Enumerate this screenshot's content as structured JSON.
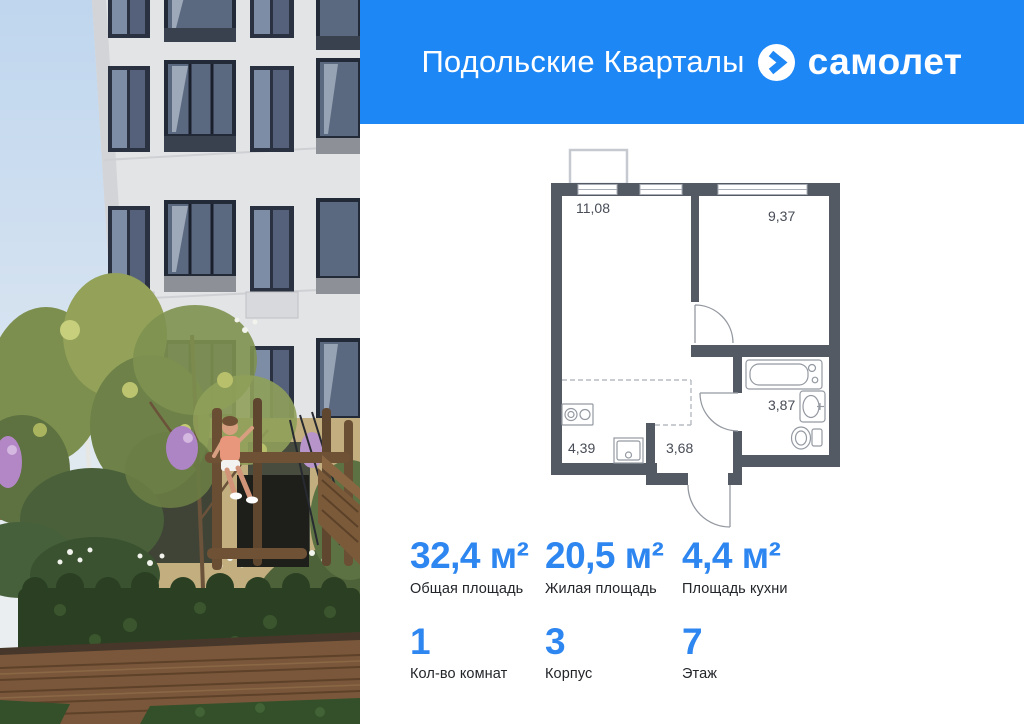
{
  "header": {
    "project_title": "Подольские Кварталы",
    "brand": "самолет",
    "header_bg": "#1e87f6",
    "accent_blue": "#2e86f0"
  },
  "plan": {
    "wall_color": "#545a64",
    "rooms": [
      {
        "name": "living-room",
        "area": "11,08"
      },
      {
        "name": "bedroom",
        "area": "9,37"
      },
      {
        "name": "kitchen",
        "area": "4,39"
      },
      {
        "name": "hall",
        "area": "3,68"
      },
      {
        "name": "bathroom",
        "area": "3,87"
      }
    ]
  },
  "stats": {
    "items": [
      {
        "value": "32,4 м²",
        "label": "Общая площадь"
      },
      {
        "value": "20,5 м²",
        "label": "Жилая площадь"
      },
      {
        "value": "4,4 м²",
        "label": "Площадь кухни"
      },
      {
        "value": "1",
        "label": "Кол-во комнат"
      },
      {
        "value": "3",
        "label": "Корпус"
      },
      {
        "value": "7",
        "label": "Этаж"
      }
    ]
  }
}
